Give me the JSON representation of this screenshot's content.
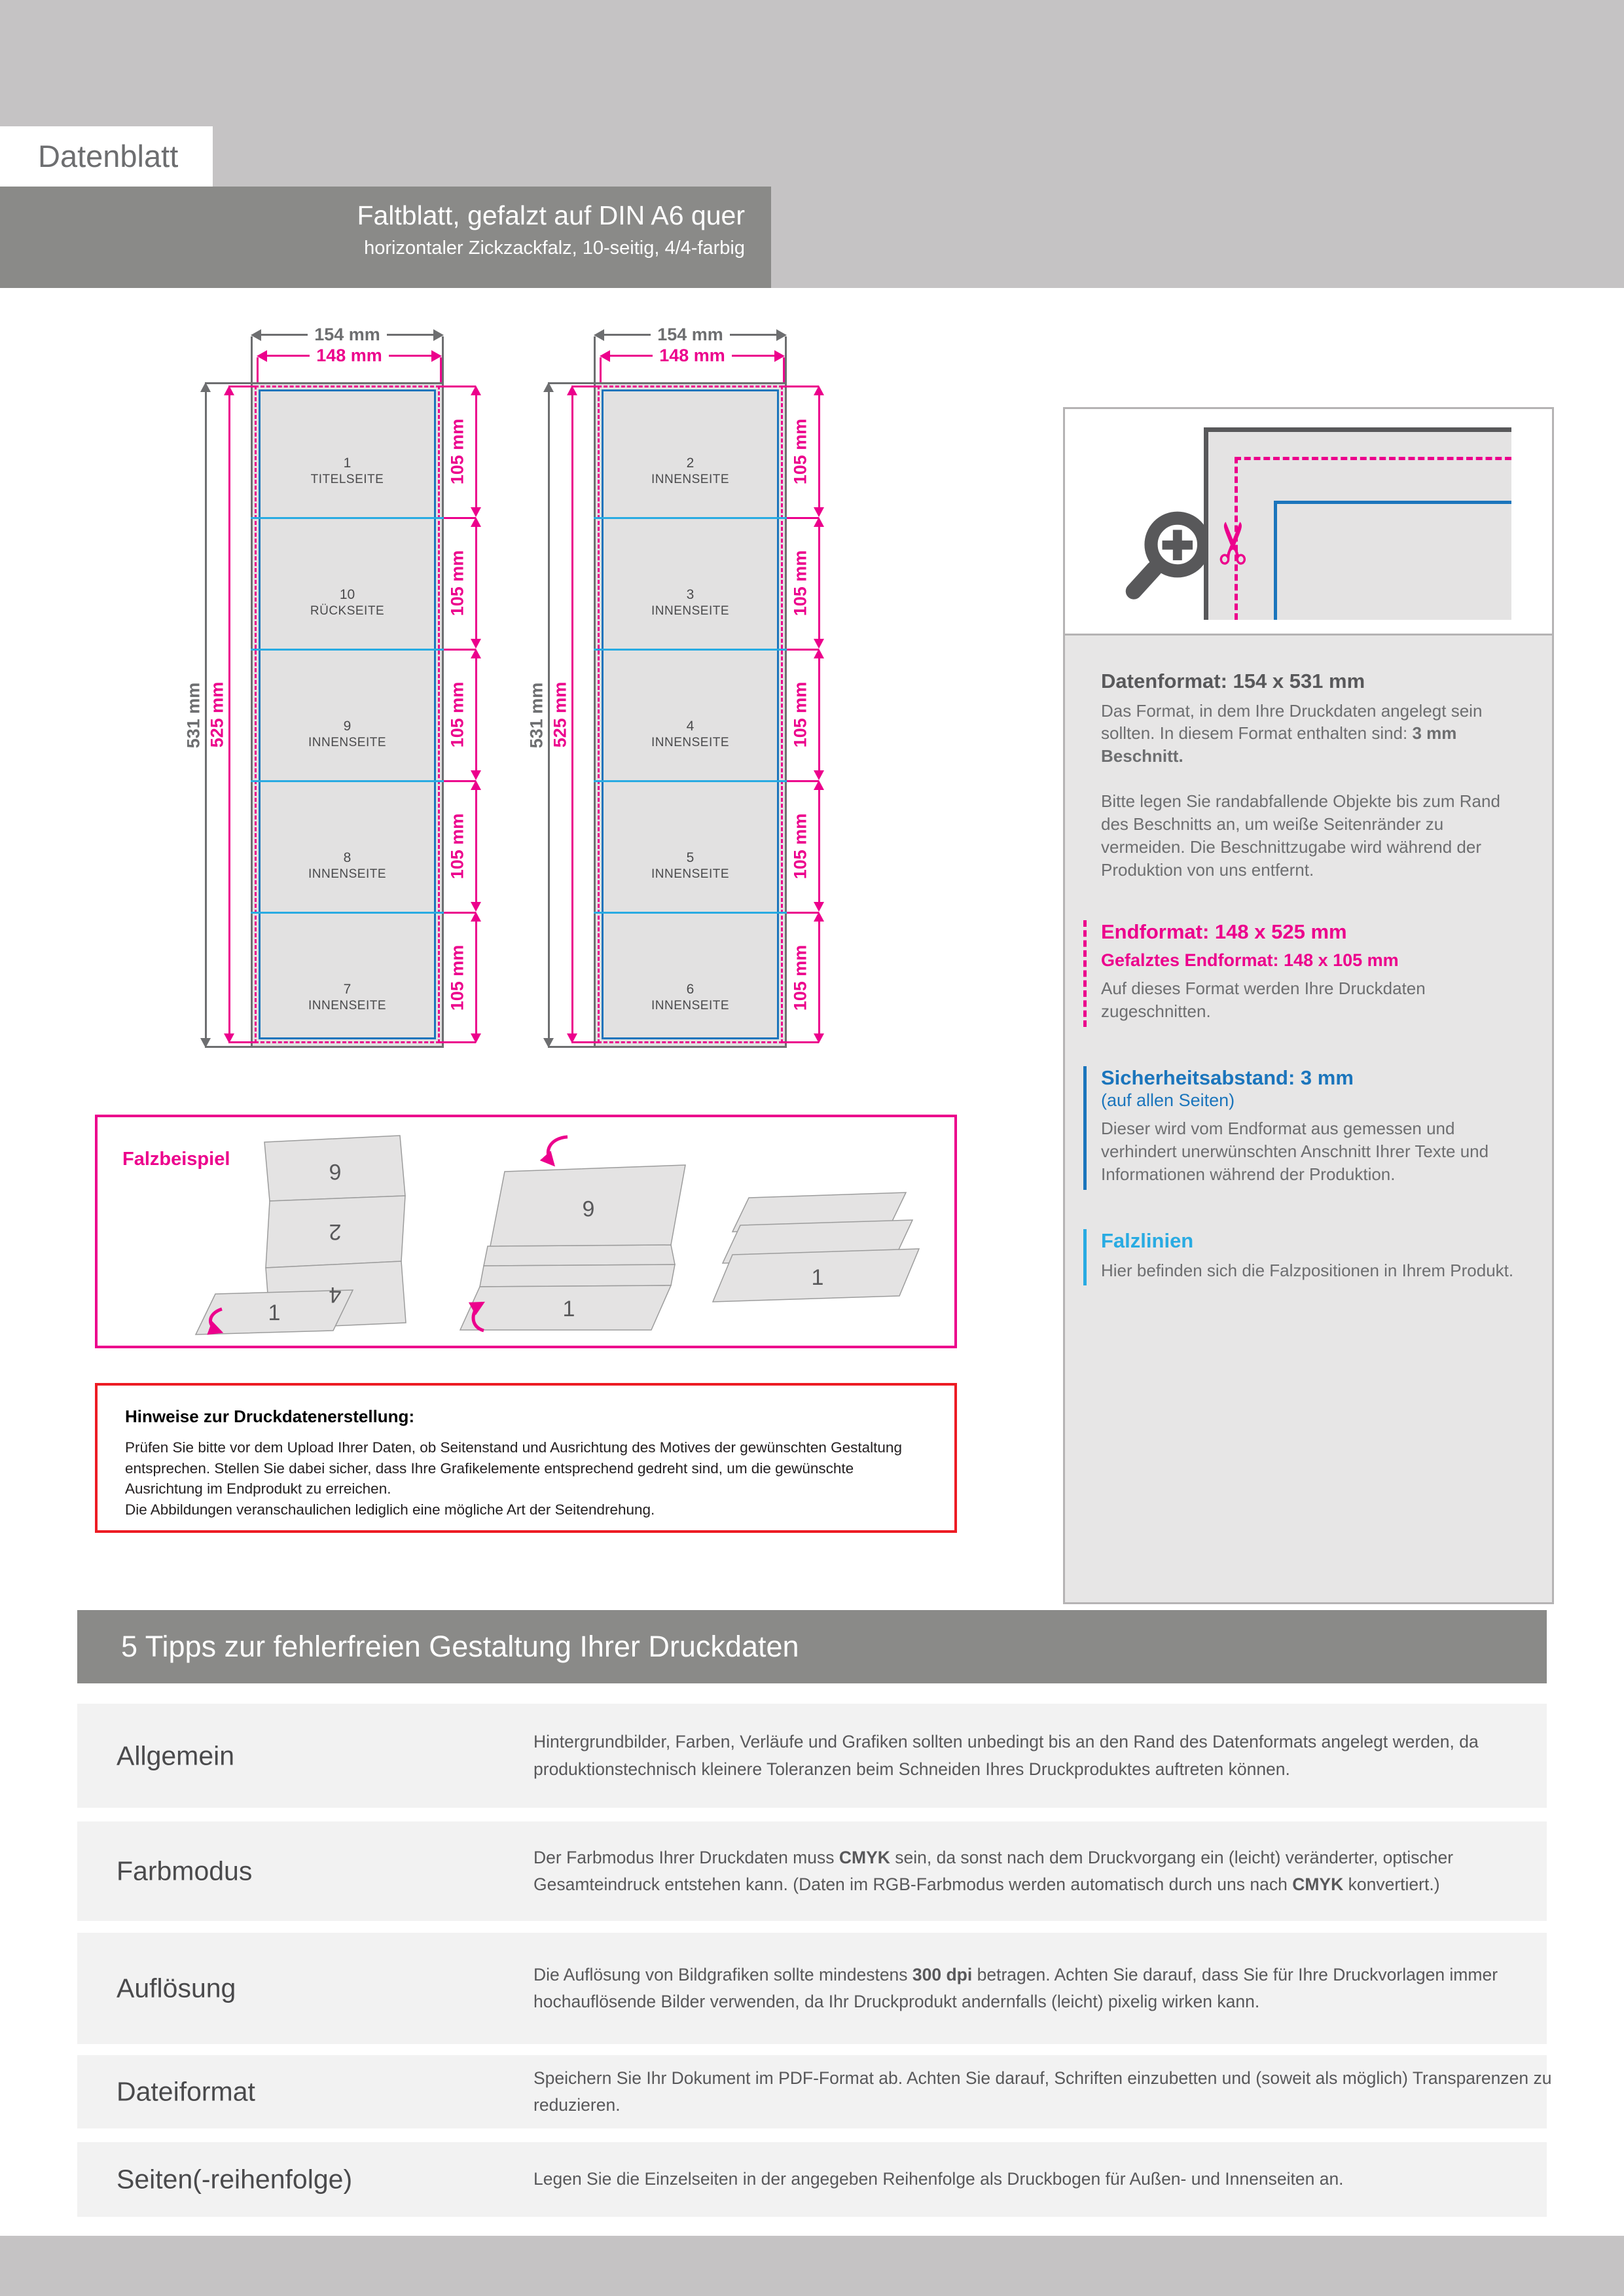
{
  "colors": {
    "magenta": "#ec008c",
    "blue": "#1b75bc",
    "cyan": "#29abe2",
    "red": "#ed1c24",
    "dark_gray": "#58585a",
    "banner_gray": "#8a8a88",
    "band_gray": "#c5c3c4"
  },
  "header": {
    "doc_label": "Datenblatt",
    "title": "Faltblatt, gefalzt auf DIN A6 quer",
    "subtitle": "horizontaler Zickzackfalz, 10-seitig, 4/4-farbig"
  },
  "dims": {
    "outer_w": "154 mm",
    "inner_w": "148 mm",
    "outer_h": "531 mm",
    "inner_h": "525 mm",
    "panel_h": "105 mm"
  },
  "sheet1": {
    "panels": [
      {
        "num": "1",
        "name": "TITELSEITE"
      },
      {
        "num": "10",
        "name": "RÜCKSEITE"
      },
      {
        "num": "9",
        "name": "INNENSEITE"
      },
      {
        "num": "8",
        "name": "INNENSEITE"
      },
      {
        "num": "7",
        "name": "INNENSEITE"
      }
    ]
  },
  "sheet2": {
    "panels": [
      {
        "num": "2",
        "name": "INNENSEITE"
      },
      {
        "num": "3",
        "name": "INNENSEITE"
      },
      {
        "num": "4",
        "name": "INNENSEITE"
      },
      {
        "num": "5",
        "name": "INNENSEITE"
      },
      {
        "num": "6",
        "name": "INNENSEITE"
      }
    ]
  },
  "card": {
    "datenformat_heading": "Datenformat: 154 x 531 mm",
    "datenformat_p1": [
      {
        "t": "Das Format, in dem Ihre Druckdaten angelegt sein sollten. In diesem Format enthalten sind: "
      },
      {
        "t": "3 mm Beschnitt.",
        "b": true
      }
    ],
    "datenformat_p2": "Bitte legen Sie randabfallende Objekte bis zum Rand des Beschnitts an, um weiße Seitenränder zu vermeiden. Die Beschnittzugabe wird während der Produktion von uns entfernt.",
    "endformat_heading": "Endformat: 148 x 525 mm",
    "endformat_sub": "Gefalztes Endformat: 148 x 105 mm",
    "endformat_p": "Auf dieses Format werden Ihre Druckdaten zugeschnitten.",
    "sicherheit_heading": "Sicherheitsabstand: 3 mm",
    "sicherheit_sub": "(auf allen Seiten)",
    "sicherheit_p": "Dieser wird vom Endformat aus gemessen und verhindert unerwünschten Anschnitt Ihrer Texte und Informationen während der Produktion.",
    "falzlinien_heading": "Falzlinien",
    "falzlinien_p": "Hier befinden sich die Falzpositionen in Ihrem Produkt."
  },
  "falzbeispiel": {
    "label": "Falzbeispiel",
    "stage1": [
      "6",
      "2",
      "4",
      "1"
    ],
    "stage2": [
      "6",
      "1"
    ],
    "stage3": [
      "1"
    ]
  },
  "hinweise": {
    "title": "Hinweise zur Druckdatenerstellung:",
    "body": "Prüfen Sie bitte vor dem Upload Ihrer Daten, ob Seitenstand und Ausrichtung des Motives der gewünschten Gestaltung entsprechen. Stellen Sie dabei sicher, dass Ihre Grafikelemente entsprechend gedreht sind, um die gewünschte Ausrichtung im Endprodukt zu erreichen.\nDie Abbildungen veranschaulichen lediglich eine mögliche Art der Seitendrehung."
  },
  "tipps": {
    "banner": "5 Tipps zur fehlerfreien Gestaltung Ihrer Druckdaten",
    "rows": [
      {
        "label": "Allgemein",
        "body": [
          {
            "t": "Hintergrundbilder, Farben, Verläufe und Grafiken sollten unbedingt bis an den Rand des Datenformats angelegt werden, da produktionstechnisch kleinere Toleranzen beim Schneiden Ihres Druckproduktes auftreten können."
          }
        ]
      },
      {
        "label": "Farbmodus",
        "body": [
          {
            "t": "Der Farbmodus Ihrer Druckdaten muss "
          },
          {
            "t": "CMYK",
            "b": true
          },
          {
            "t": " sein, da sonst nach dem Druckvorgang ein (leicht) veränderter, optischer Gesamteindruck entstehen kann. (Daten im RGB-Farbmodus werden automatisch durch uns nach "
          },
          {
            "t": "CMYK",
            "b": true
          },
          {
            "t": " konvertiert.)"
          }
        ]
      },
      {
        "label": "Auflösung",
        "body": [
          {
            "t": "Die Auflösung von Bildgrafiken sollte mindestens "
          },
          {
            "t": "300 dpi",
            "b": true
          },
          {
            "t": " betragen. Achten Sie darauf, dass Sie für Ihre Druckvorlagen immer hochauflösende Bilder verwenden, da Ihr Druckprodukt andernfalls (leicht) pixelig wirken kann."
          }
        ]
      },
      {
        "label": "Dateiformat",
        "body": [
          {
            "t": "Speichern Sie Ihr Dokument im PDF-Format ab. Achten Sie darauf, Schriften einzubetten und (soweit als möglich) Transparenzen zu reduzieren."
          }
        ]
      },
      {
        "label": "Seiten(-reihenfolge)",
        "body": [
          {
            "t": "Legen Sie die Einzelseiten in der angegeben Reihenfolge als Druckbogen für Außen- und Innenseiten an."
          }
        ]
      }
    ]
  }
}
